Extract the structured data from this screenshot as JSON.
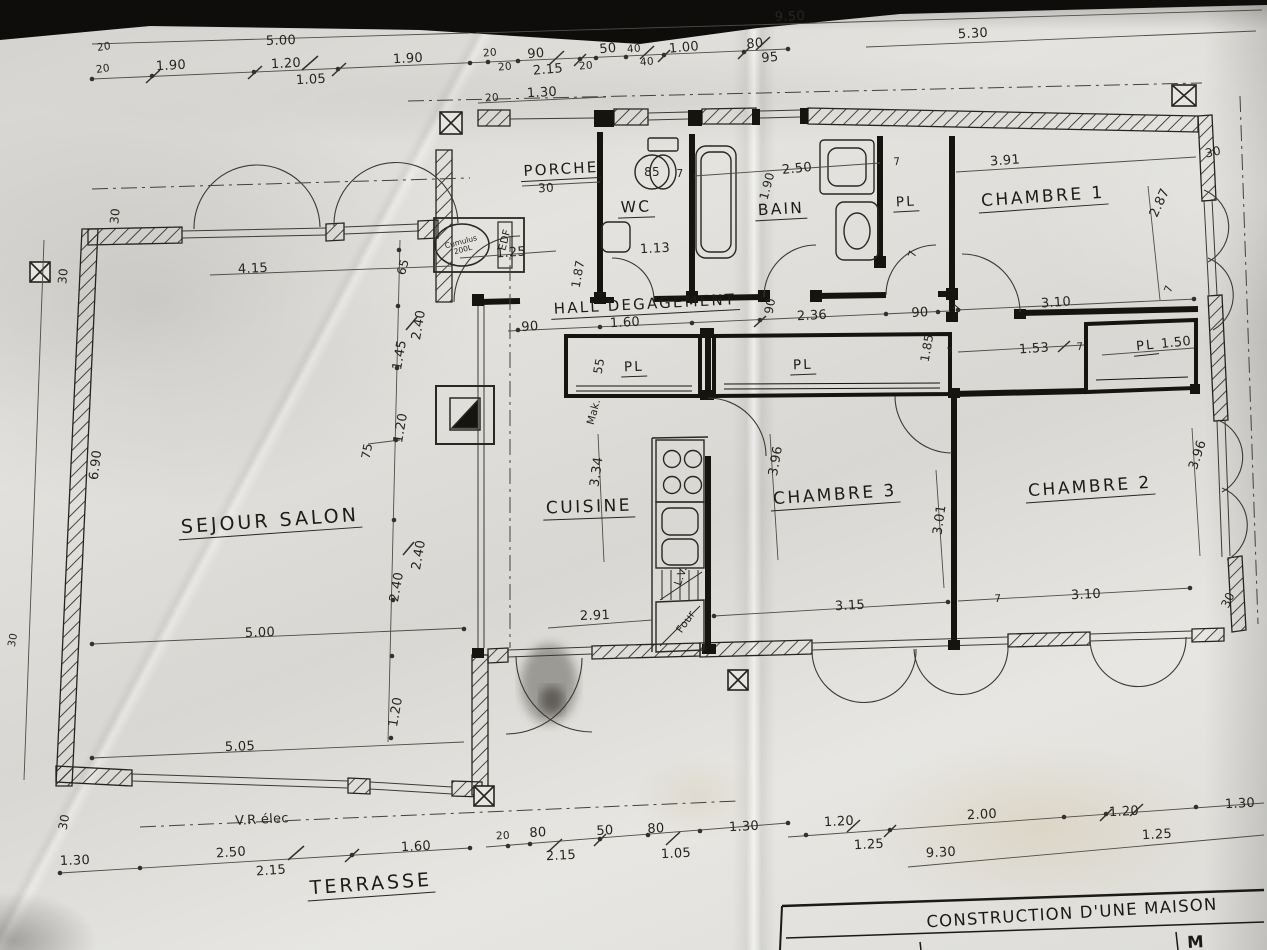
{
  "title_block": {
    "line1": "CONSTRUCTION D'UNE MAISON",
    "line2": "M"
  },
  "rooms": {
    "porche": "PORCHE",
    "wc": "WC",
    "bain": "BAIN",
    "pl_bain": "PL",
    "chambre1": "CHAMBRE 1",
    "hall": "HALL  DEGAGEMENT",
    "pl_cuisine": "PL",
    "pl_chambre3": "PL",
    "pl_chambre2": "PL",
    "sejour": "SEJOUR  SALON",
    "cuisine": "CUISINE",
    "chambre3": "CHAMBRE 3",
    "chambre2": "CHAMBRE 2",
    "terrasse": "TERRASSE"
  },
  "annotations": {
    "edf": "EDF",
    "cumulus": "Cumulus 200L",
    "vr": "V.R élec",
    "lv": "L.V.",
    "four": "Four",
    "mak": "Mak.",
    "wc85": "85"
  },
  "dims": {
    "d950": "9.50",
    "d500top": "5.00",
    "d530": "5.30",
    "d20a": "20",
    "d20b": "20",
    "d190a": "1.90",
    "d120a": "1.20",
    "d105a": "1.05",
    "d190b": "1.90",
    "d20c": "20",
    "d20d": "20",
    "d90a": "90",
    "d215a": "2.15",
    "d20e": "20",
    "d50a": "50",
    "d40a": "40",
    "d40b": "40",
    "d100": "1.00",
    "d80a": "80",
    "d95": "95",
    "d20f": "20",
    "d130a": "1.30",
    "d30tr": "30",
    "d287": "2.87",
    "d7a": "7",
    "d150": "1.50",
    "d396a": "3.96",
    "d30br": "30",
    "d30lt1": "30",
    "d30lt2": "30",
    "d690": "6.90",
    "d30lb1": "30",
    "d30lb2": "30",
    "d130bl": "1.30",
    "d415": "4.15",
    "d65": "65",
    "d125a": "1.25",
    "d30p": "30",
    "d113": "1.13",
    "d187": "1.87",
    "d250a": "2.50",
    "d190c": "1.90",
    "d7b": "7",
    "d391": "3.91",
    "d7c": "7",
    "d90b": "90",
    "d7d": "7",
    "d160a": "1.60",
    "d90c": "90",
    "d236": "2.36",
    "d90d": "90",
    "d7e": "7",
    "d185": "1.85",
    "d55": "55",
    "d310a": "3.10",
    "d153": "1.53",
    "d7f": "7",
    "d7g": "7",
    "d145": "1.45",
    "d240a": "2.40",
    "d120b": "1.20",
    "d75": "75",
    "d240b": "2.40",
    "d240c": "2.40",
    "d334": "3.34",
    "d291": "2.91",
    "d396b": "3.96",
    "d301": "3.01",
    "d315": "3.15",
    "d7h": "7",
    "d310b": "3.10",
    "d500b": "5.00",
    "d505": "5.05",
    "d120c": "1.20",
    "d250b": "2.50",
    "d215b": "2.15",
    "d160b": "1.60",
    "d20g": "20",
    "d80b": "80",
    "d215c": "2.15",
    "d50b": "50",
    "d80c": "80",
    "d105b": "1.05",
    "d130c": "1.30",
    "d120d": "1.20",
    "d125b": "1.25",
    "d200": "2.00",
    "d930": "9.30",
    "d120e": "1.20",
    "d125c": "1.25",
    "d130d": "1.30"
  }
}
